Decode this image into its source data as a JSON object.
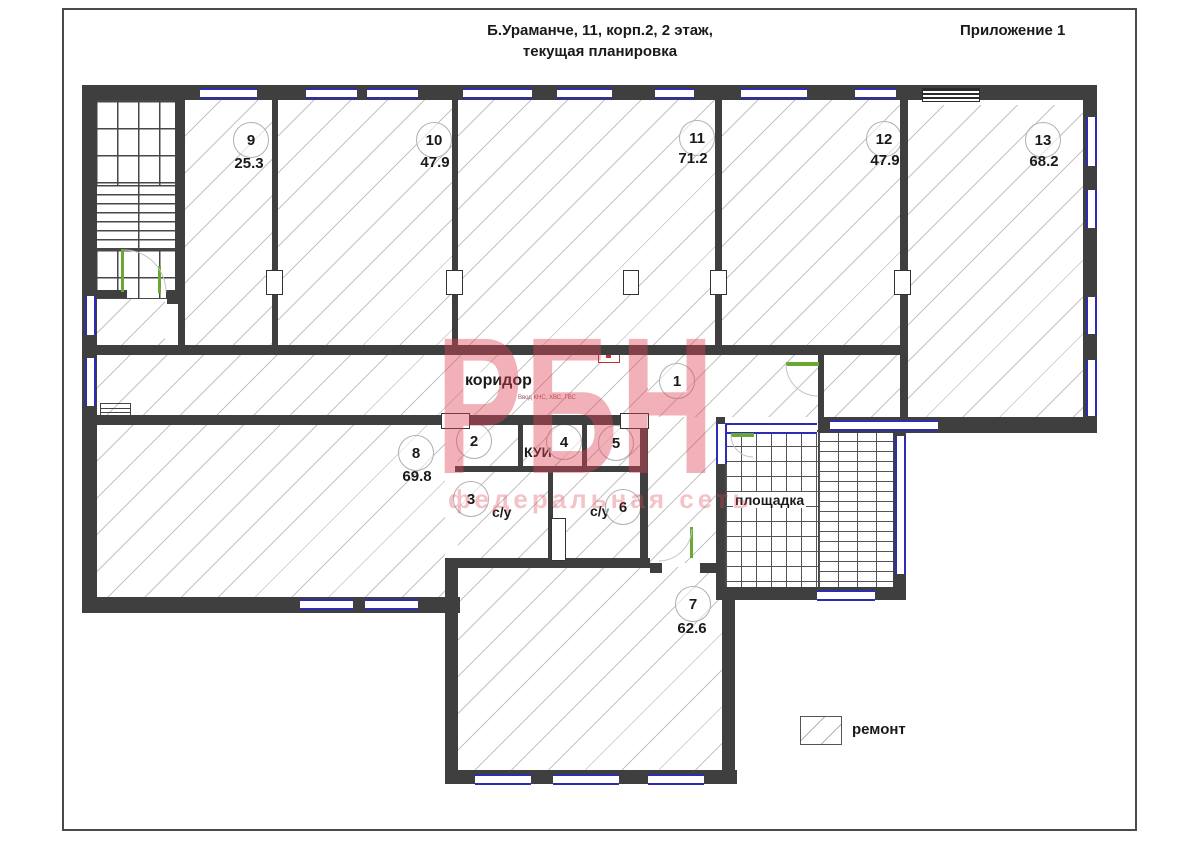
{
  "header": {
    "title_line1": "Б.Ураманче, 11, корп.2, 2 этаж,",
    "title_line2": "текущая планировка",
    "annex": "Приложение 1"
  },
  "watermark": {
    "main": "РБН",
    "sub": "федеральная сеть",
    "color": "#df4655"
  },
  "labels": {
    "corridor": "коридор",
    "utility_note": "Ввод КНС, ХВС, ГВС",
    "storage": "КУИ",
    "wc": "с/у",
    "landing": "площадка"
  },
  "legend": {
    "repair_label": "ремонт"
  },
  "rooms": [
    {
      "number": "9",
      "area": "25.3"
    },
    {
      "number": "10",
      "area": "47.9"
    },
    {
      "number": "11",
      "area": "71.2"
    },
    {
      "number": "12",
      "area": "47.9"
    },
    {
      "number": "13",
      "area": "68.2"
    },
    {
      "number": "8",
      "area": "69.8"
    },
    {
      "number": "7",
      "area": "62.6"
    }
  ],
  "units": [
    {
      "number": "1"
    },
    {
      "number": "2"
    },
    {
      "number": "3"
    },
    {
      "number": "4"
    },
    {
      "number": "5"
    },
    {
      "number": "6"
    }
  ]
}
